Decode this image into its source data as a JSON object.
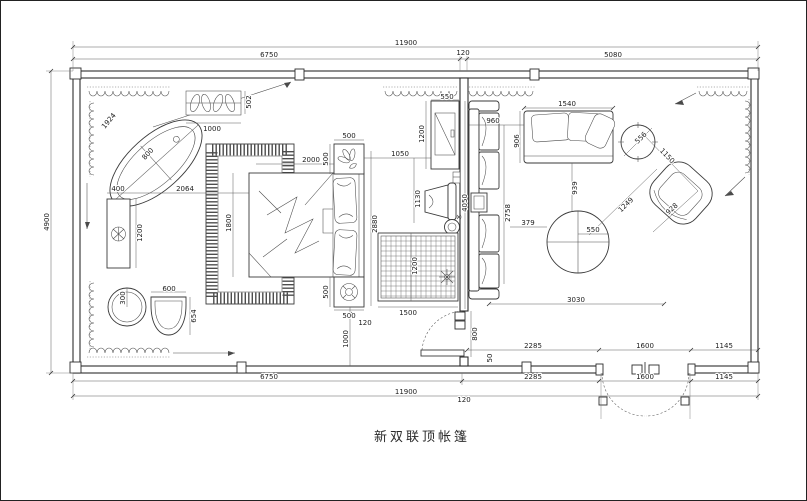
{
  "title": {
    "text": "新双联顶帐篷"
  },
  "colors": {
    "line": "#3a3a3a",
    "dim_text": "#1c1c1c",
    "background": "#ffffff"
  },
  "icons": {
    "bathtub-icon": "rotated double ellipse",
    "radiator-icon": "rect with petal scrolls",
    "vanity-icon": "long rect with round sink",
    "toilet-icon": "double circle",
    "basin-chair-icon": "U bowl",
    "bed-icon": "rect with duvet folds and two pillows",
    "rug-fringe-icon": "dashed border rect",
    "nightstand-plant-icon": "leaf cluster",
    "nightstand-flower-icon": "flower knob",
    "tv-cabinet-icon": "rect with crossed screen",
    "desk-chair-icon": "trapezoid with back",
    "stool-icon": "double circle with tail",
    "grid-rug-icon": "rect with square grid",
    "sofa-icon": "rect with cushions",
    "armchair-icon": "rounded rotated square",
    "coffee-table-icon": "circle with cross",
    "side-table-icon": "circle with ticks",
    "door-swing-icon": "dashed quarter arc",
    "curtain-icon": "scallop loops"
  },
  "labels": {
    "top_total": "11900",
    "top_seg_left": "6750",
    "top_seg_mid": "120",
    "top_seg_right": "5080",
    "left_total": "4900",
    "bot_in_2285": "2285",
    "bot_in_1600": "1600",
    "bot_in_1145": "1145",
    "bot_seg_6750": "6750",
    "bot_seg_2285": "2285",
    "bot_seg_1600": "1600",
    "bot_seg_1145": "1145",
    "bot_total": "11900",
    "bot_mid_120": "120",
    "tub_len": "1924",
    "tub_wid": "800",
    "rad_w": "1000",
    "rad_d": "502",
    "van_w": "400",
    "van_gap": "2064",
    "van_l": "1200",
    "bed_w": "1800",
    "bed_l": "2000",
    "ns_top_w": "500",
    "ns_top_d": "500",
    "ns_bot_d": "500",
    "ns_bot_w": "500",
    "toilet_d": "300",
    "basin_w": "600",
    "basin_d": "654",
    "gap_120": "120",
    "gap_1000": "1000",
    "rug2_w": "1500",
    "rug2_l": "1200",
    "room_d": "2880",
    "tv_gap": "1050",
    "chair_d": "1130",
    "tv_w": "550",
    "tv_l": "1200",
    "sofa_gap": "960",
    "liv_d": "4050",
    "lsofa_l": "2758",
    "sofa_w": "1540",
    "sofa_d": "906",
    "tbl_gap": "939",
    "tbl_off": "379",
    "tbl_d": "550",
    "diag_1249": "1249",
    "stbl_d": "556",
    "ac_w": "1150",
    "ac_d": "928",
    "liv_w": "3030",
    "door_w": "800",
    "wall_50": "50"
  }
}
